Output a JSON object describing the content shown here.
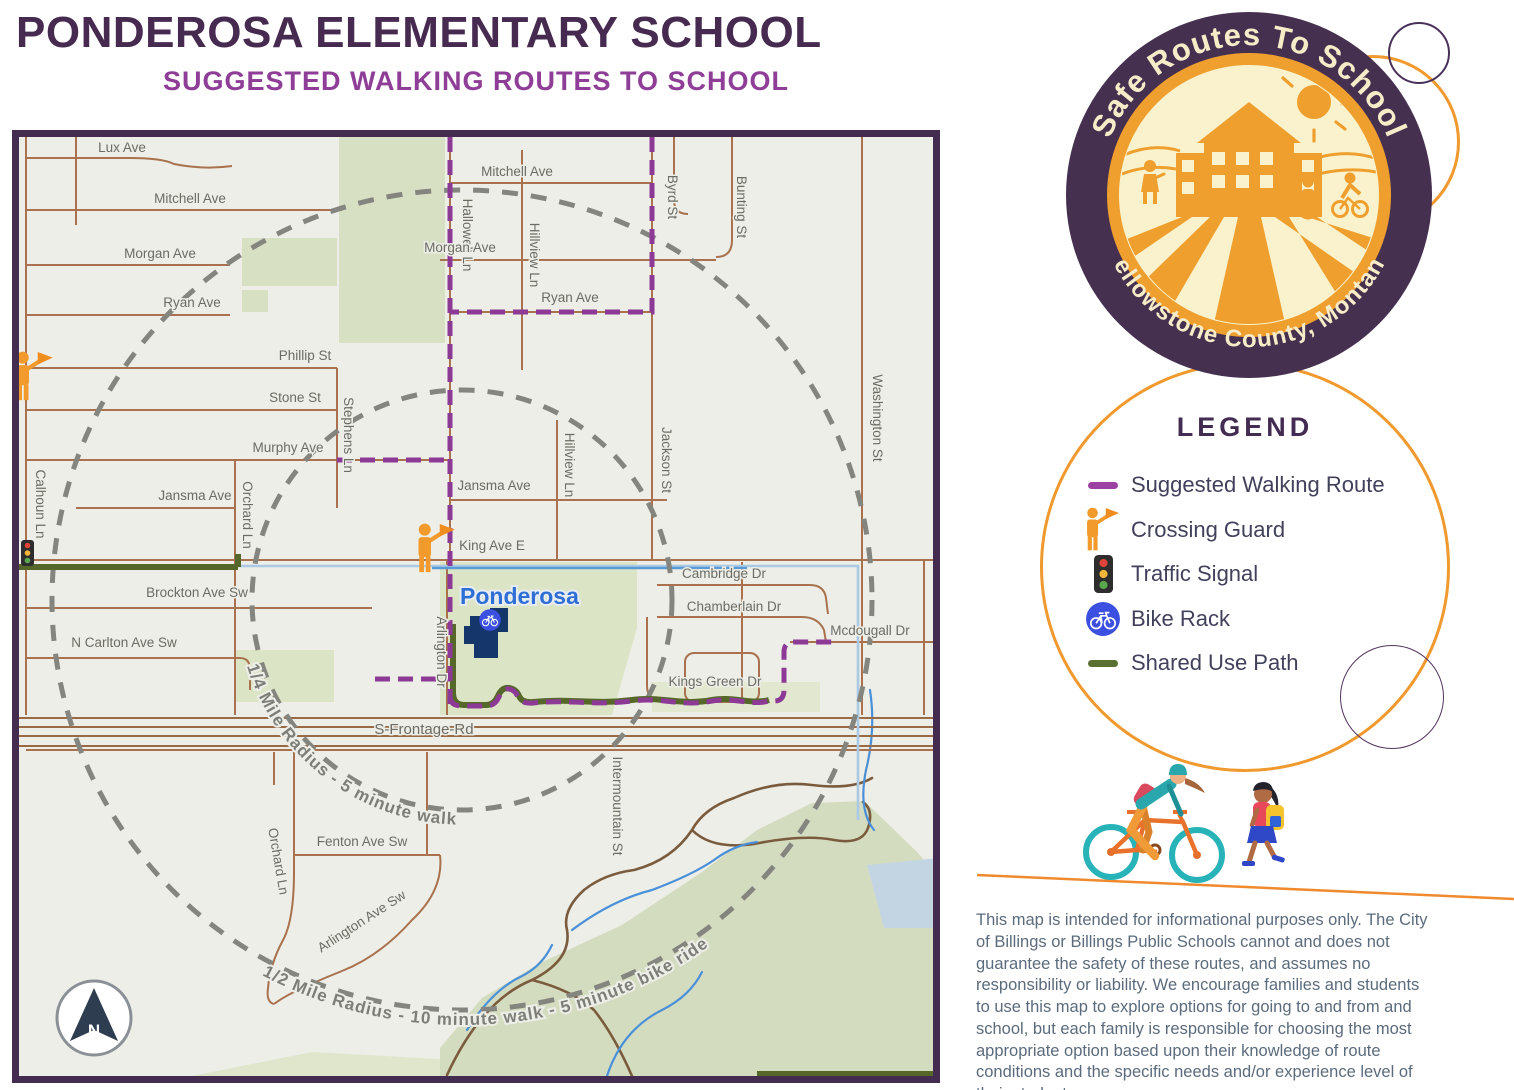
{
  "header": {
    "title": "PONDEROSA ELEMENTARY SCHOOL",
    "subtitle": "SUGGESTED WALKING ROUTES TO SCHOOL"
  },
  "badge": {
    "top_text": "Safe Routes To School",
    "bottom_text": "Yellowstone County, Montana"
  },
  "legend": {
    "title": "LEGEND",
    "items": [
      {
        "icon": "walking-route-dash",
        "label": "Suggested Walking Route"
      },
      {
        "icon": "crossing-guard",
        "label": "Crossing Guard"
      },
      {
        "icon": "traffic-signal",
        "label": "Traffic Signal"
      },
      {
        "icon": "bike-rack",
        "label": "Bike Rack"
      },
      {
        "icon": "shared-use-path-dash",
        "label": "Shared Use Path"
      }
    ]
  },
  "map": {
    "school_name": "Ponderosa",
    "compass_label": "N",
    "radius_rings": {
      "inner": "1/4 Mile Radius - 5 minute walk",
      "outer": "1/2 Mile Radius - 10 minute walk - 5 minute bike ride"
    },
    "streets": [
      "Lux Ave",
      "Mitchell Ave",
      "Morgan Ave",
      "Ryan Ave",
      "Phillip St",
      "Stone St",
      "Murphy Ave",
      "Jansma Ave",
      "Calhoun Ln",
      "Orchard Ln",
      "Stephens Ln",
      "Hallowell Ln",
      "Mitchell Ave",
      "Hillview Ln",
      "Morgan Ave",
      "Ryan Ave",
      "Byrd St",
      "Bunting St",
      "Washington St",
      "Jackson St",
      "Hillview Ln",
      "Jansma Ave",
      "King Ave E",
      "Arlington Dr",
      "Brockton Ave Sw",
      "N Carlton Ave Sw",
      "Cambridge Dr",
      "Chamberlain Dr",
      "Mcdougall Dr",
      "Kings Green Dr",
      "S-Frontage-Rd",
      "Orchard Ln",
      "Fenton Ave Sw",
      "Arlington Ave Sw",
      "Intermountain St"
    ]
  },
  "disclaimer": "This map is intended for informational purposes only. The City of Billings or Billings Public Schools cannot and does not guarantee the safety of these routes, and assumes no responsibility or liability. We encourage families and students to use this map to explore options for going to and from and school, but each family is responsible for choosing the most appropriate option based upon their knowledge of route conditions and the specific needs and/or experience level of their student.",
  "colors": {
    "title_purple": "#472a50",
    "subtitle_purple": "#8f3e97",
    "route_purple": "#8c3a96",
    "path_green": "#55682a",
    "badge_orange": "#f0992e",
    "badge_plum": "#463050",
    "map_background": "#eceee7",
    "road_brown": "#a9714d",
    "school_blue": "#15366b"
  }
}
